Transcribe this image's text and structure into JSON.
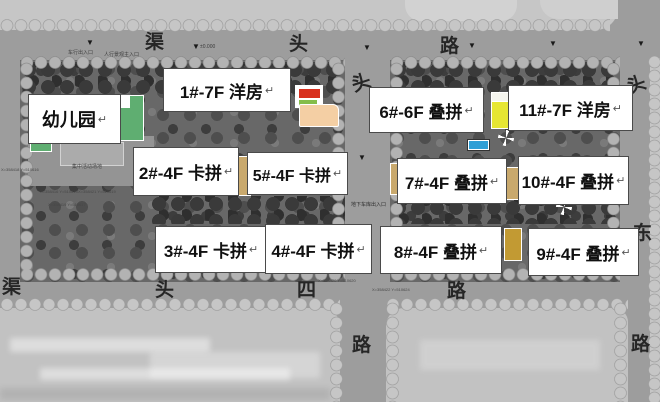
{
  "map_type": "residential site plan",
  "glyphs": {
    "return_mark": "↵",
    "entrance_arrow": "▼"
  },
  "roads": {
    "labels": [
      {
        "text": "渠"
      },
      {
        "text": "头"
      },
      {
        "text": "路"
      },
      {
        "text": "头"
      },
      {
        "text": "头"
      },
      {
        "text": "东"
      },
      {
        "text": "路"
      },
      {
        "text": "渠"
      },
      {
        "text": "头"
      },
      {
        "text": "四"
      },
      {
        "text": "路"
      },
      {
        "text": "路"
      }
    ],
    "top_road_reading": "渠头路",
    "bottom_road_reading": "渠头四路"
  },
  "buildings": {
    "boxes": [
      {
        "label": "幼儿园"
      },
      {
        "label": "1#-7F 洋房"
      },
      {
        "label": "2#-4F 卡拼"
      },
      {
        "label": "5#-4F 卡拼"
      },
      {
        "label": "6#-6F 叠拼"
      },
      {
        "label": "11#-7F 洋房"
      },
      {
        "label": "7#-4F 叠拼"
      },
      {
        "label": "10#-4F 叠拼"
      },
      {
        "label": "3#-4F 卡拼"
      },
      {
        "label": "4#-4F 卡拼"
      },
      {
        "label": "8#-4F 叠拼"
      },
      {
        "label": "9#-4F 叠拼"
      }
    ]
  },
  "annotations": [
    {
      "text": "车行出入口"
    },
    {
      "text": "人行景观主入口"
    },
    {
      "text": "±0.000"
    },
    {
      "text": "地下车库出入口"
    },
    {
      "text": "X=358418 Y=510616"
    },
    {
      "text": "X=358416 Y=510613"
    },
    {
      "text": "X=358421 Y=510619"
    },
    {
      "text": "X=358419 Y=510617"
    },
    {
      "text": "X=358420 Y=510620"
    },
    {
      "text": "X=358422 Y=510624"
    },
    {
      "text": "集中活动场地"
    }
  ],
  "colors": {
    "road_gray": "#9d9d9d",
    "block_gray": "#c4c4c4",
    "site_gray": "#686868",
    "label_box_bg": "#ffffff",
    "kindergarten_green": "#5fae71",
    "highlight_red": "#d8301f",
    "highlight_green": "#85bd4a",
    "highlight_peach": "#f4cfa4",
    "highlight_yellow": "#e6e632",
    "highlight_cyan": "#2f9fd6",
    "highlight_tan": "#c9a96d",
    "highlight_gold": "#c29a33"
  }
}
